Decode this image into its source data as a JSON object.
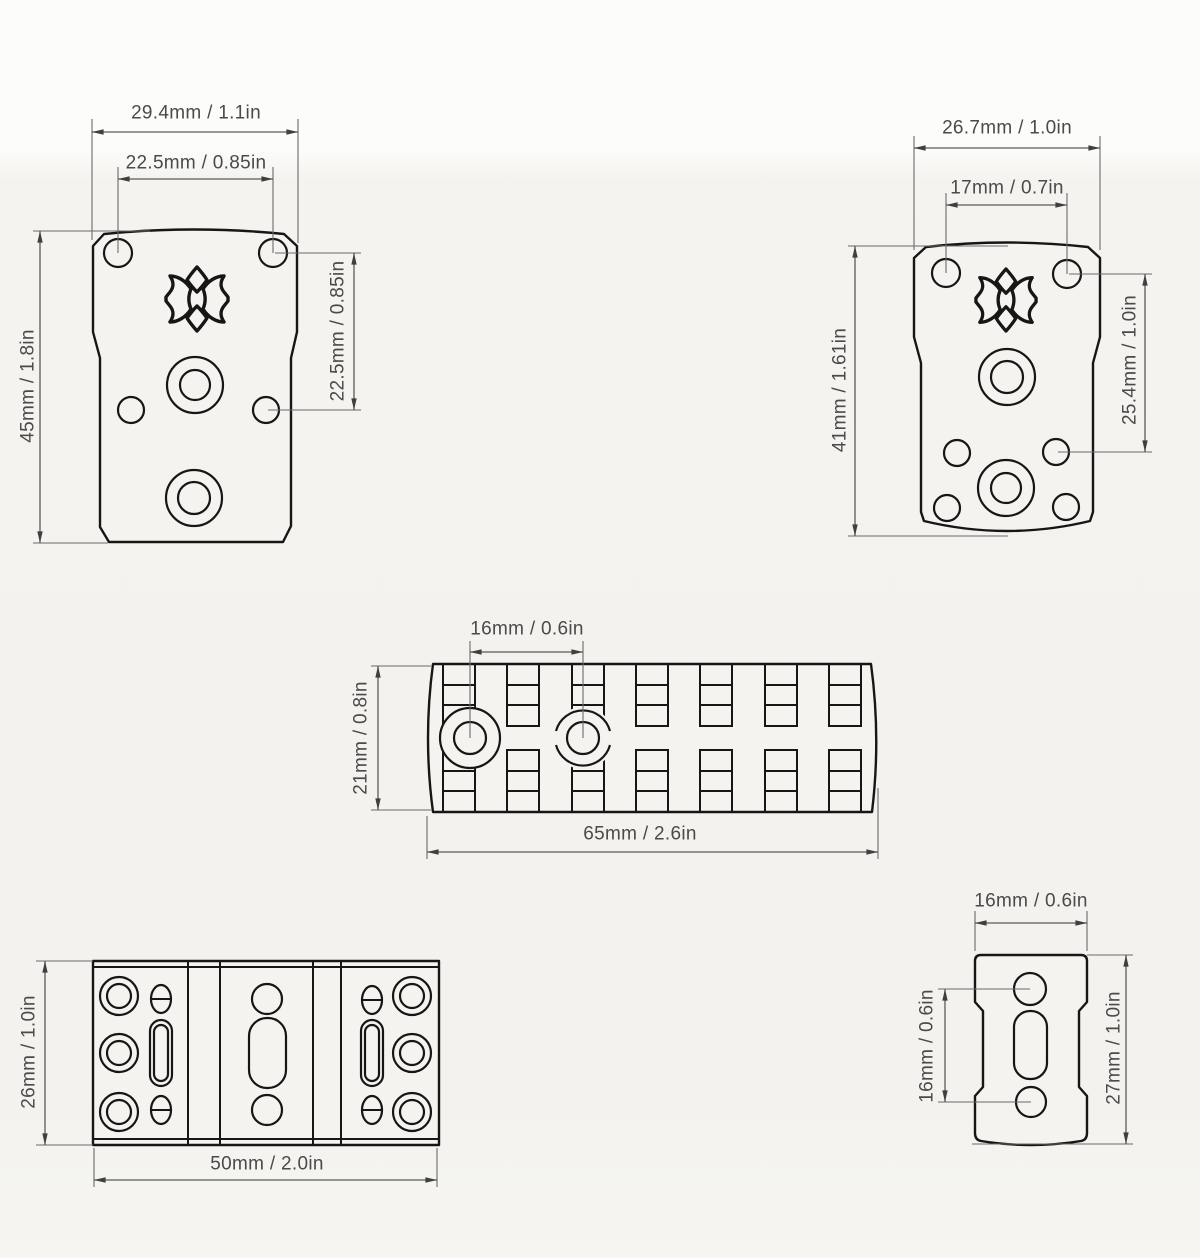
{
  "page": {
    "background": "#f4f3ef",
    "background_top": "#fcfcfb",
    "outline_color": "#161616",
    "dimension_line_color": "#5a5a5a",
    "text_color": "#4a4a4a"
  },
  "icons": {
    "plate_logo": "star-cross-logo"
  },
  "parts": {
    "top_left_plate": {
      "dims": {
        "width": "29.4mm / 1.1in",
        "hole_spacing_h": "22.5mm / 0.85in",
        "height": "45mm / 1.8in",
        "hole_spacing_v": "22.5mm / 0.85in"
      }
    },
    "top_right_plate": {
      "dims": {
        "width": "26.7mm / 1.0in",
        "hole_spacing_h": "17mm / 0.7in",
        "height": "41mm / 1.61in",
        "hole_spacing_v": "25.4mm / 1.0in"
      }
    },
    "picatinny_rail": {
      "dims": {
        "hole_spacing": "16mm / 0.6in",
        "height": "21mm / 0.8in",
        "width": "65mm / 2.6in"
      }
    },
    "bottom_left_rail": {
      "dims": {
        "height": "26mm / 1.0in",
        "width": "50mm / 2.0in"
      }
    },
    "bottom_right_plate": {
      "dims": {
        "width": "16mm / 0.6in",
        "hole_spacing": "16mm / 0.6in",
        "height": "27mm / 1.0in"
      }
    }
  }
}
